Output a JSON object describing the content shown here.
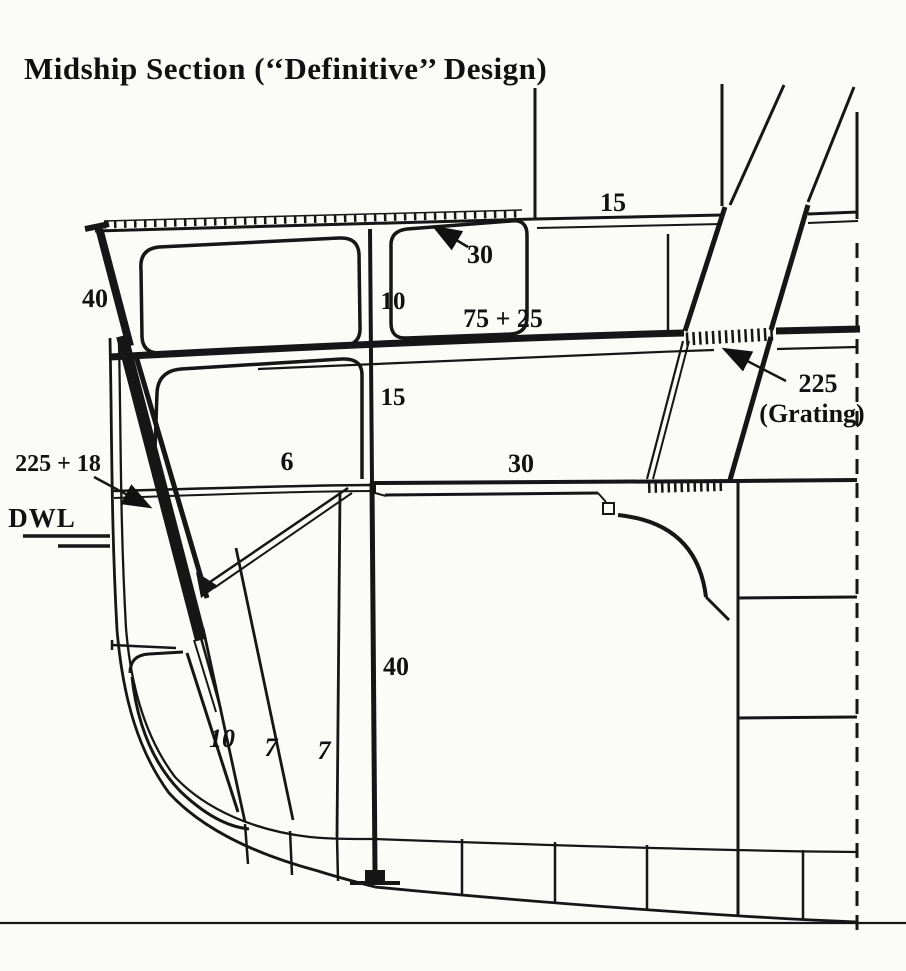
{
  "page": {
    "background": "#fbfbf8",
    "ink": "#161616"
  },
  "title": "Midship Section (‘‘Definitive’’ Design)",
  "diagram": {
    "name": "warship-midship-half-section",
    "labels": {
      "top_deck": "15",
      "top_plating": "30",
      "sheer_strake": "40",
      "upper_side": "10",
      "armored_deck": "75 + 25",
      "mid_side": "15",
      "grating_value": "225",
      "grating_note": "(Grating)",
      "main_belt": "225 + 18",
      "waterline": "DWL",
      "middle_deck_inner": "6",
      "middle_deck": "30",
      "lower_bulkhead": "40",
      "holding_bulkhead": "10",
      "splinter_1": "7",
      "splinter_2": "7"
    }
  }
}
